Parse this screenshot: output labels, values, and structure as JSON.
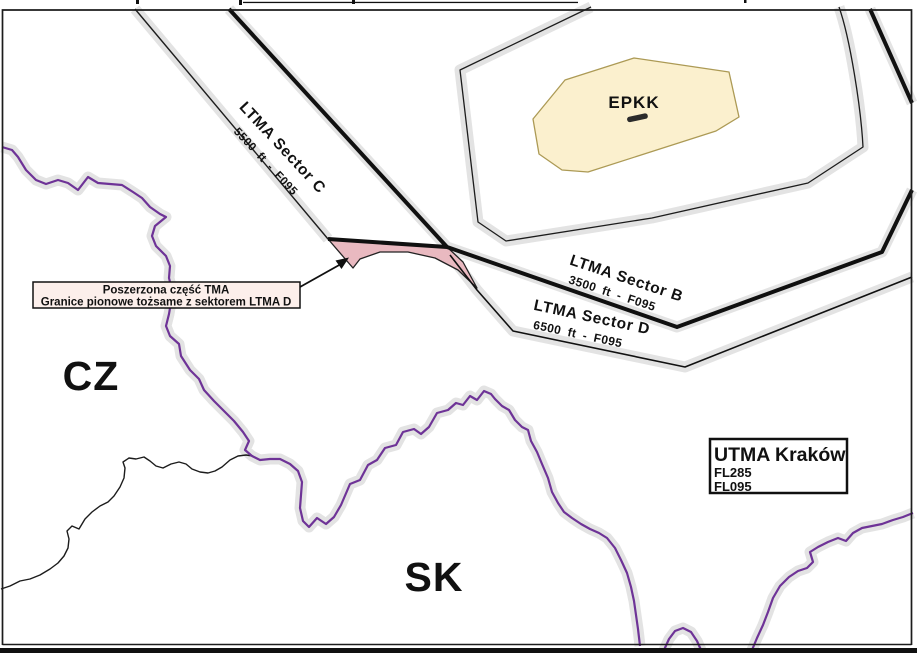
{
  "map": {
    "countries": {
      "cz": "CZ",
      "sk": "SK"
    },
    "airport": {
      "code": "EPKK"
    },
    "sectors": {
      "c": {
        "name": "LTMA Sector C",
        "levels": "5500 ft - F095"
      },
      "b": {
        "name": "LTMA Sector B",
        "levels": "3500 ft - F095"
      },
      "d": {
        "name": "LTMA Sector D",
        "levels": "6500 ft - F095"
      }
    },
    "utma_box": {
      "title": "UTMA Kraków",
      "upper_limit": "FL285",
      "lower_limit": "FL095"
    },
    "annotation": {
      "line1": "Poszerzona część TMA",
      "line2": "Granice pionowe tożsame z sektorem LTMA D"
    },
    "colors": {
      "border_purple": "#6e3397",
      "expanded_tma_pink": "#e9b9c0",
      "annotation_bg": "#fcefeb",
      "airport_fill": "#fbf0ce",
      "airport_stroke": "#ac9a55",
      "shadow_gray": "#e3e3e3"
    }
  }
}
